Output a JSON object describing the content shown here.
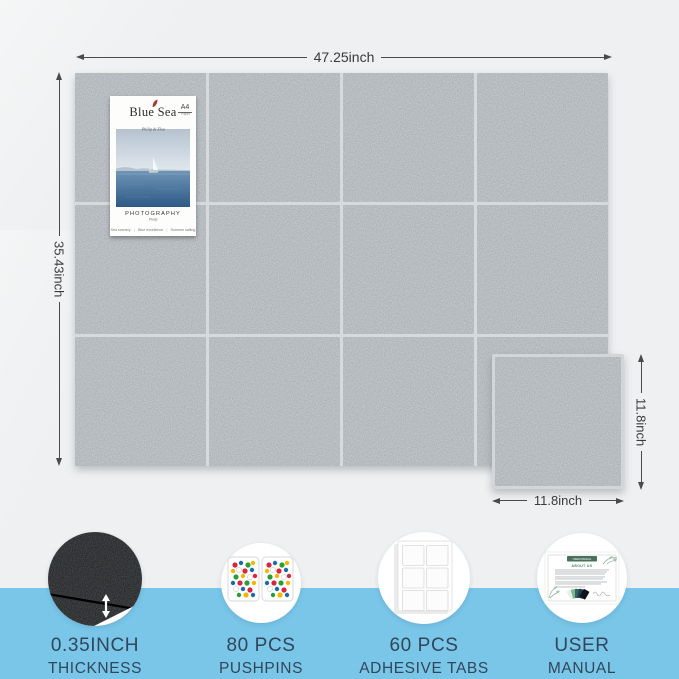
{
  "page": {
    "background_top": "#eef0f1",
    "background_band": "#79c6e9",
    "tile_color": "#a8adb2",
    "gap_color": "#d6dadc",
    "label_color": "#32465a"
  },
  "dimensions": {
    "board_width": "47.25inch",
    "board_height": "35.43inch",
    "tile_height": "11.8inch",
    "tile_width": "11.8inch"
  },
  "board": {
    "rows": 3,
    "columns": 4
  },
  "poster": {
    "title": "Blue Sea",
    "subtitle": "Philip & Elsa",
    "badge_top": "A4",
    "badge_bottom": "Paper",
    "caption_title": "PHOTOGRAPHY",
    "caption_sub": "Philip",
    "footer_items": [
      "Sea scenery",
      "Blue excellence",
      "Summer sailing"
    ],
    "footer_separator": "|"
  },
  "manual_card": {
    "pill_label": "USER MANUAL",
    "heading": "ABOUT US"
  },
  "features": [
    {
      "id": "thickness",
      "line1": "0.35INCH",
      "line2": "THICKNESS"
    },
    {
      "id": "pushpins",
      "line1": "80 PCS",
      "line2": "PUSHPINS"
    },
    {
      "id": "adhesive-tabs",
      "line1": "60 PCS",
      "line2": "ADHESIVE TABS"
    },
    {
      "id": "user-manual",
      "line1": "USER",
      "line2": "MANUAL"
    }
  ]
}
